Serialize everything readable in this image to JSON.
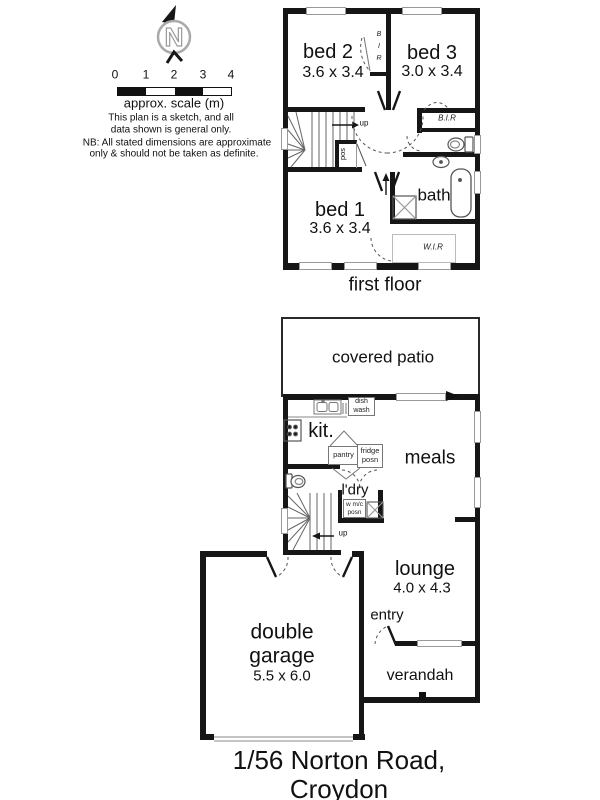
{
  "palette": {
    "ink": "#161616",
    "window_stroke": "#999999",
    "thin_line": "#555555"
  },
  "compass": {
    "letter": "N"
  },
  "scale_bar": {
    "ticks": [
      "0",
      "1",
      "2",
      "3",
      "4"
    ],
    "caption": "approx. scale (m)",
    "note_line1": "This plan is a sketch, and all",
    "note_line2": "data shown is general only.",
    "note_line3": "NB: All stated dimensions are approximate",
    "note_line4": "only & should not be taken as definite."
  },
  "first_floor": {
    "caption": "first floor",
    "bed1_name": "bed 1",
    "bed1_dims": "3.6 x 3.4",
    "bed2_name": "bed 2",
    "bed2_dims": "3.6 x 3.4",
    "bed3_name": "bed 3",
    "bed3_dims": "3.0 x 3.4",
    "bath": "bath",
    "bir_robe_vertical": "B\nI\nR",
    "bir_robe": "B.I.R",
    "wir_robe": "W.I.R",
    "cupboard": "pos",
    "stairs_up": "up"
  },
  "ground_floor": {
    "covered_patio": "covered patio",
    "kitchen": "kit.",
    "meals": "meals",
    "laundry": "l'dry",
    "lounge_name": "lounge",
    "lounge_dims": "4.0 x 4.3",
    "entry": "entry",
    "verandah": "verandah",
    "garage_name": "double\ngarage",
    "garage_dims": "5.5 x 6.0",
    "dishwasher": "dish\nwash",
    "pantry": "pantry",
    "fridge": "fridge\nposn",
    "washing_machine": "w m/c\nposn",
    "stairs_up": "up"
  },
  "footer": {
    "address": "1/56 Norton Road, Croydon"
  }
}
